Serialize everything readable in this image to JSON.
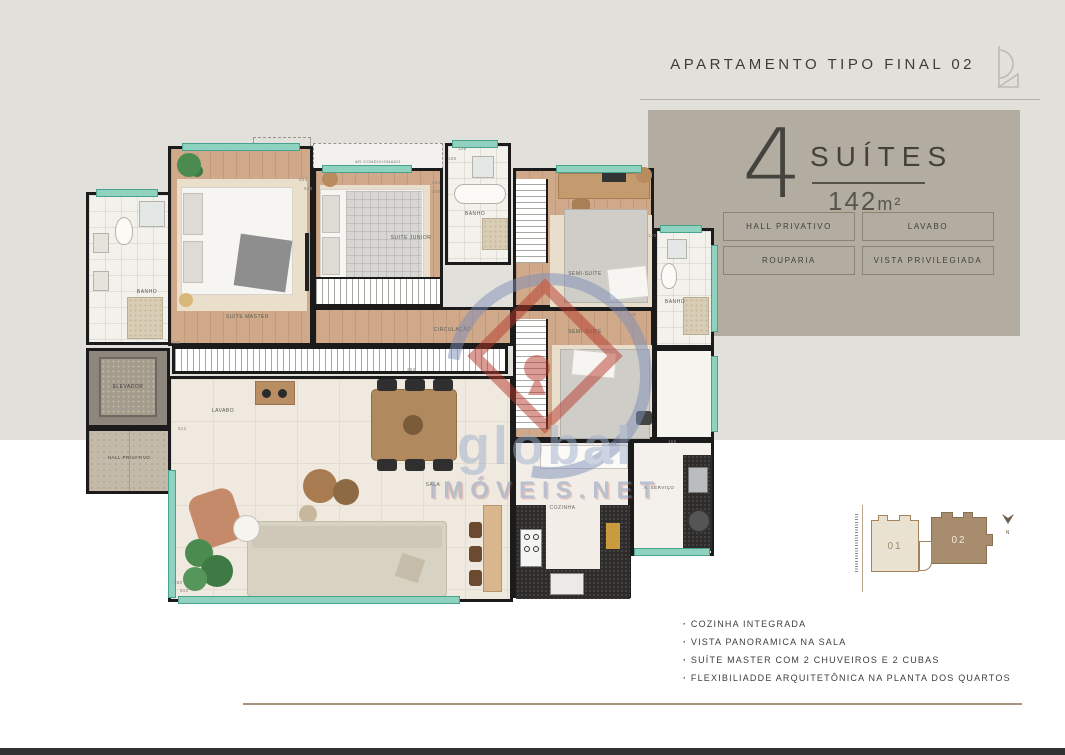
{
  "header": {
    "title": "APARTAMENTO TIPO FINAL 02"
  },
  "info_panel": {
    "suites_number": "4",
    "suites_label": "SUÍTES",
    "area_value": "142",
    "area_unit": "m²",
    "badges": [
      "HALL PRIVATIVO",
      "LAVABO",
      "ROUPARIA",
      "VISTA PRIVILEGIADA"
    ]
  },
  "floor_plan": {
    "rooms": {
      "banho_master": "BANHO",
      "suite_master": "SUITE MASTER",
      "suite_junior": "SUITE JUNIOR",
      "banho_top": "BANHO",
      "semi_suite_1": "SEMI-SUÍTE",
      "banho_right": "BANHO",
      "circulacao": "CIRCULAÇÃO",
      "semi_suite_2": "SEMI-SUÍTE",
      "elevador": "ELEVADOR",
      "hall_privativo": "HALL PRIVATIVO",
      "lavabo": "LAVABO",
      "sala": "SALA",
      "cozinha": "COZINHA",
      "servico": "A. SERVIÇO",
      "ar_condicionado": "AR CONDICIONADO"
    },
    "dimensions": [
      {
        "text": "545",
        "x": 172,
        "y": 340
      },
      {
        "text": "250",
        "x": 407,
        "y": 367
      },
      {
        "text": "533",
        "x": 299,
        "y": 177
      },
      {
        "text": "519",
        "x": 304,
        "y": 186
      },
      {
        "text": "320",
        "x": 432,
        "y": 180
      },
      {
        "text": "205",
        "x": 432,
        "y": 189
      },
      {
        "text": "126",
        "x": 458,
        "y": 146
      },
      {
        "text": "195",
        "x": 448,
        "y": 156
      },
      {
        "text": "120",
        "x": 648,
        "y": 233
      },
      {
        "text": "120",
        "x": 628,
        "y": 312
      },
      {
        "text": "512",
        "x": 178,
        "y": 426
      },
      {
        "text": "265",
        "x": 608,
        "y": 441
      },
      {
        "text": "166",
        "x": 668,
        "y": 439
      },
      {
        "text": "380",
        "x": 174,
        "y": 580
      },
      {
        "text": "610",
        "x": 180,
        "y": 588
      }
    ]
  },
  "watermark": {
    "line1": "global",
    "line2": "IMÓVEIS.NET"
  },
  "key_plan": {
    "unit_left": "01",
    "unit_right": "02",
    "north_label": "N"
  },
  "features": [
    "COZINHA INTEGRADA",
    "VISTA PANORAMICA NA SALA",
    "SUÍTE MASTER COM 2 CHUVEIROS E 2 CUBAS",
    "FLEXIBILIADDE ARQUITETÔNICA NA PLANTA DOS QUARTOS"
  ],
  "colors": {
    "panel_bg": "#b2ada0",
    "badge_border": "#8e8370",
    "accent_line": "#a5947a",
    "wood_floor": "#cfa98a",
    "wall": "#1b1b1b",
    "window_glass": "#8ed2bf",
    "unit01_fill": "#eae2d1",
    "unit02_fill": "#a78c6d"
  }
}
